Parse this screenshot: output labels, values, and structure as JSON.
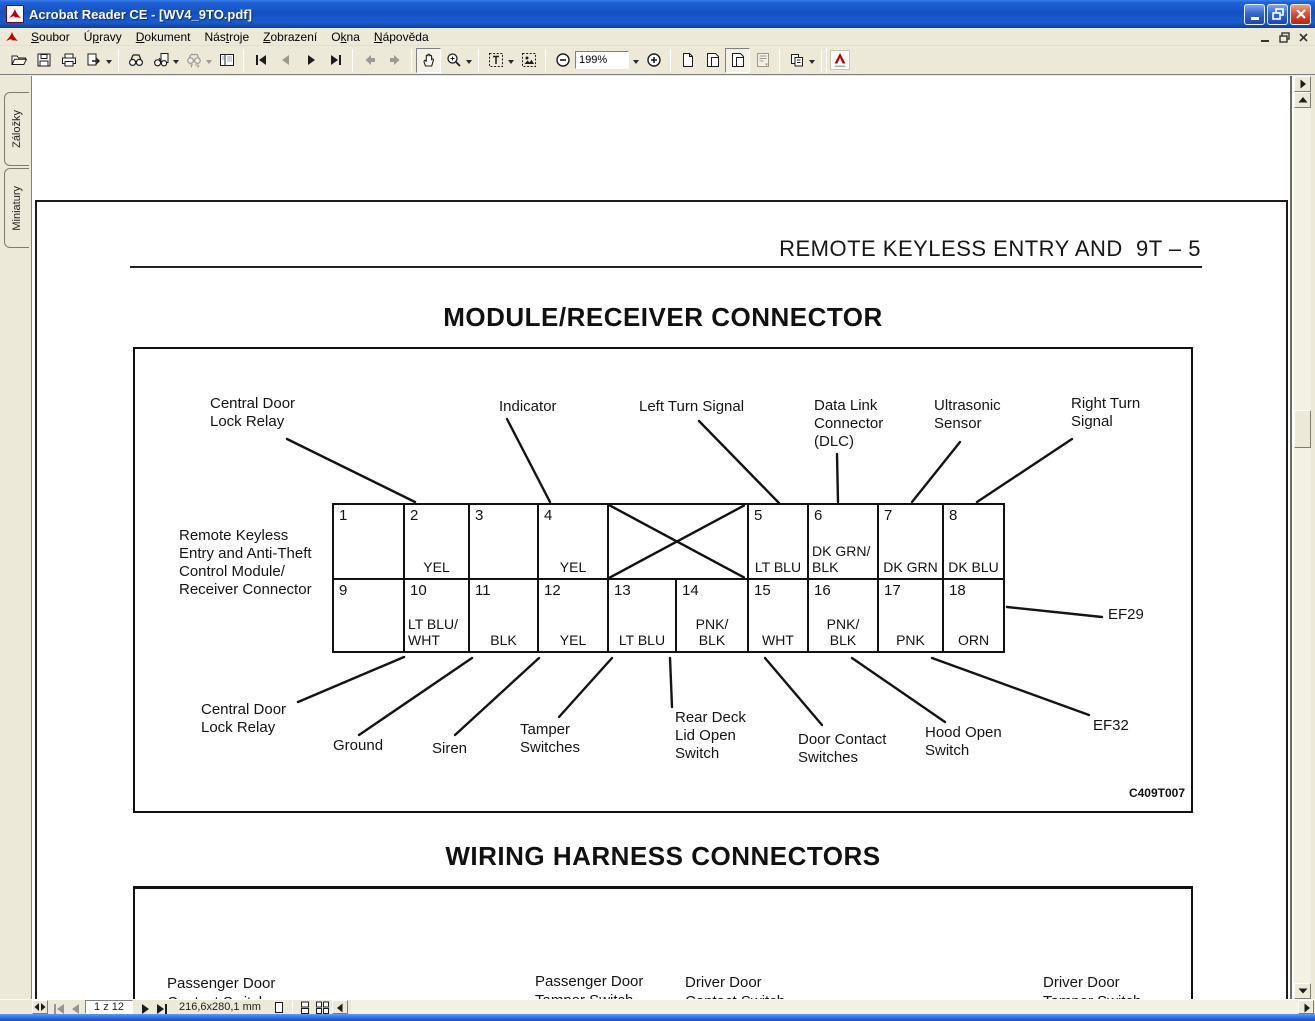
{
  "window": {
    "title": "Acrobat Reader CE - [WV4_9TO.pdf]"
  },
  "menu": {
    "items": [
      {
        "pre": "",
        "key": "S",
        "post": "oubor"
      },
      {
        "pre": "Ú",
        "key": "p",
        "post": "ravy"
      },
      {
        "pre": "",
        "key": "D",
        "post": "okument"
      },
      {
        "pre": "Nás",
        "key": "t",
        "post": "roje"
      },
      {
        "pre": "",
        "key": "Z",
        "post": "obrazení"
      },
      {
        "pre": "O",
        "key": "k",
        "post": "na"
      },
      {
        "pre": "",
        "key": "N",
        "post": "ápověda"
      }
    ]
  },
  "toolbar": {
    "zoom_value": "199%"
  },
  "sidebar": {
    "tabs": [
      "Záložky",
      "Miniatury"
    ]
  },
  "doc": {
    "page_header": "REMOTE KEYLESS ENTRY AND  9T – 5",
    "section1_title": "MODULE/RECEIVER CONNECTOR",
    "section2_title": "WIRING HARNESS CONNECTORS",
    "figure_code": "C409T007",
    "connector": {
      "left_label": "Remote Keyless\nEntry and Anti-Theft\nControl Module/\nReceiver Connector",
      "top_labels": {
        "central": "Central Door\nLock Relay",
        "indicator": "Indicator",
        "left_turn": "Left Turn Signal",
        "dlc": "Data Link\nConnector\n(DLC)",
        "ultrasonic": "Ultrasonic\nSensor",
        "right_turn": "Right Turn\nSignal"
      },
      "bottom_labels": {
        "central": "Central Door\nLock Relay",
        "ground": "Ground",
        "siren": "Siren",
        "tamper": "Tamper\nSwitches",
        "rear_deck": "Rear Deck\nLid Open\nSwitch",
        "door_contact": "Door Contact\nSwitches",
        "hood": "Hood Open\nSwitch",
        "ef32": "EF32",
        "ef29": "EF29"
      },
      "pins_top": [
        {
          "pin": "1",
          "color": ""
        },
        {
          "pin": "2",
          "color": "YEL"
        },
        {
          "pin": "3",
          "color": ""
        },
        {
          "pin": "4",
          "color": "YEL"
        },
        {
          "pin": "5",
          "color": "LT BLU"
        },
        {
          "pin": "6",
          "color": "DK GRN/\nBLK"
        },
        {
          "pin": "7",
          "color": "DK GRN"
        },
        {
          "pin": "8",
          "color": "DK BLU"
        }
      ],
      "pins_bottom": [
        {
          "pin": "9",
          "color": ""
        },
        {
          "pin": "10",
          "color": "LT BLU/\nWHT"
        },
        {
          "pin": "11",
          "color": "BLK"
        },
        {
          "pin": "12",
          "color": "YEL"
        },
        {
          "pin": "13",
          "color": "LT BLU"
        },
        {
          "pin": "14",
          "color": "PNK/\nBLK"
        },
        {
          "pin": "15",
          "color": "WHT"
        },
        {
          "pin": "16",
          "color": "PNK/\nBLK"
        },
        {
          "pin": "17",
          "color": "PNK"
        },
        {
          "pin": "18",
          "color": "ORN"
        }
      ]
    },
    "harness_labels": [
      "Passenger Door\nContact Switch",
      "Passenger Door\nTamper Switch",
      "Driver Door\nContact Switch",
      "Driver Door\nTamper Switch"
    ]
  },
  "statusbar": {
    "page": "1 z 12",
    "dimensions": "216,6x280,1 mm"
  }
}
